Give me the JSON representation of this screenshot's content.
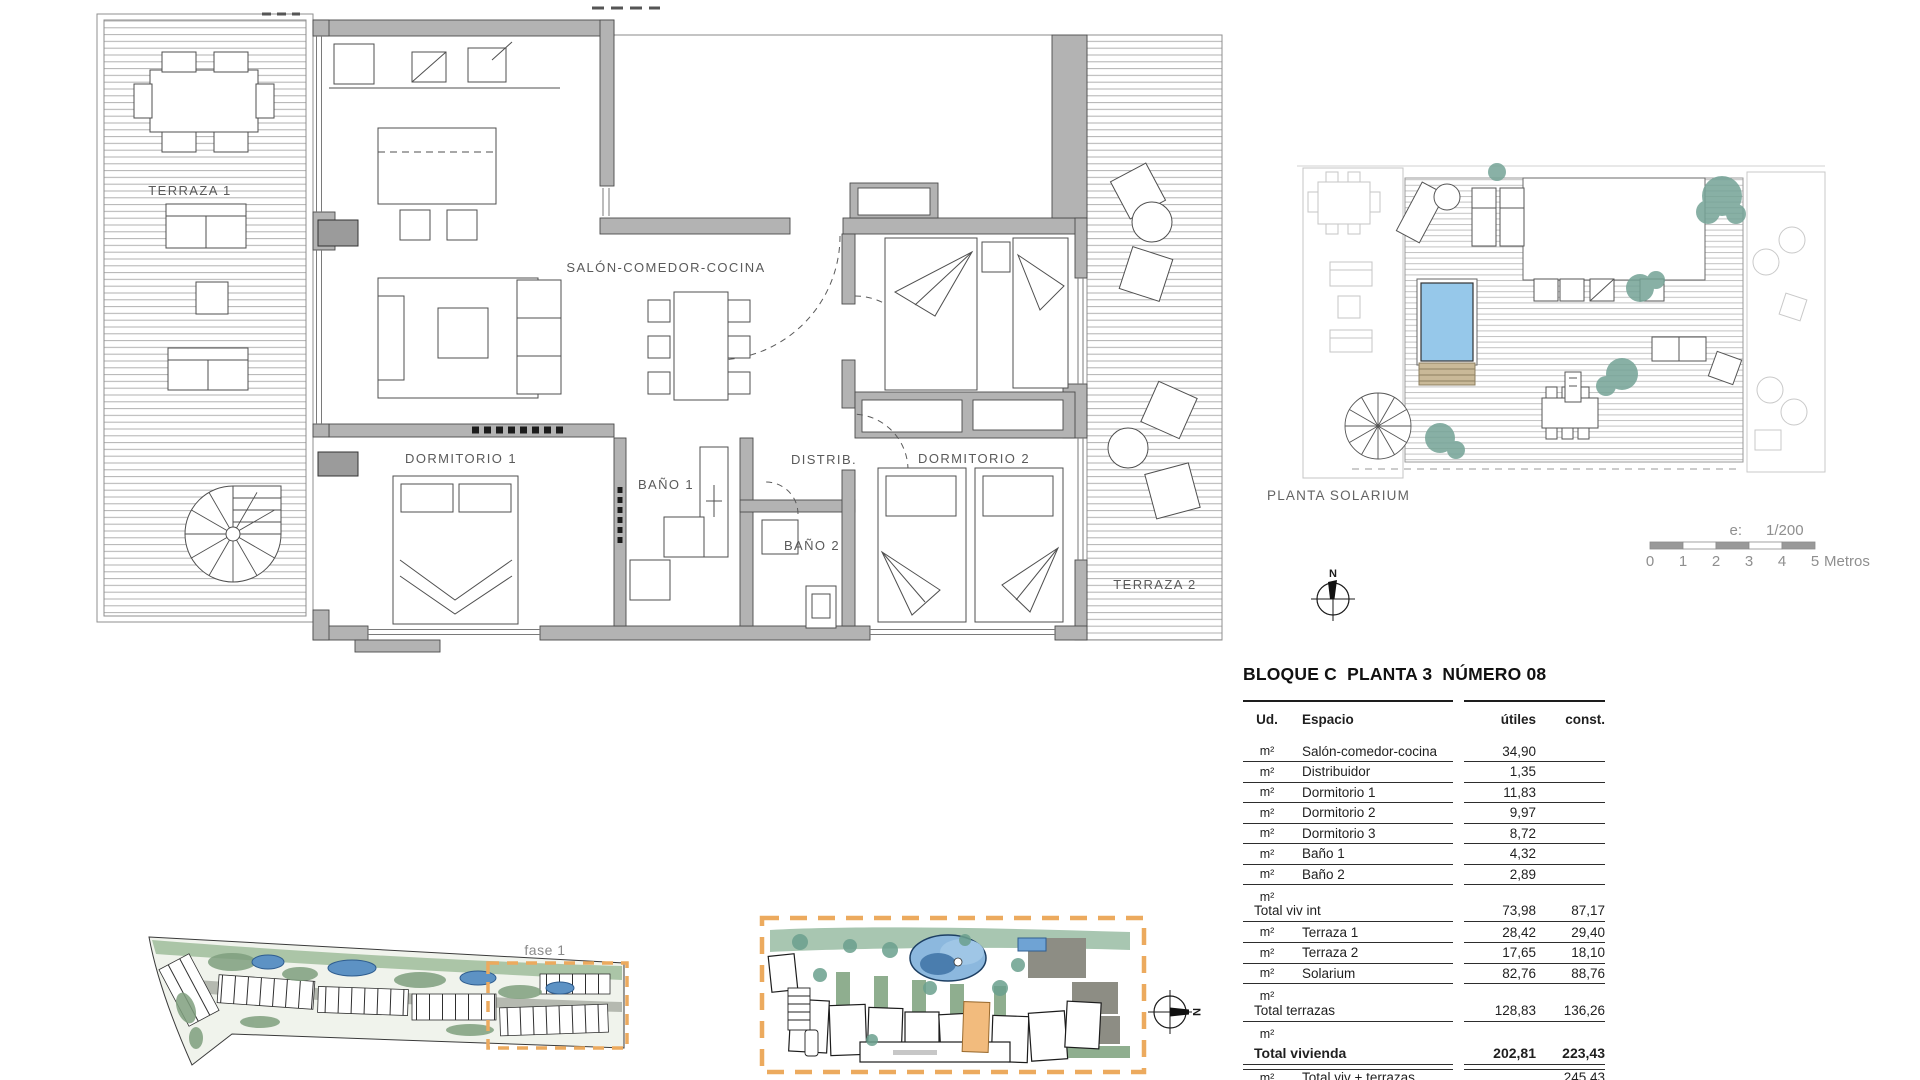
{
  "plan": {
    "labels": {
      "terraza1": "TERRAZA 1",
      "salon": "SALÓN-COMEDOR-COCINA",
      "dormitorio1": "DORMITORIO 1",
      "bano1": "BAÑO 1",
      "distrib": "DISTRIB.",
      "bano2": "BAÑO 2",
      "dormitorio2": "DORMITORIO 2",
      "terraza2": "TERRAZA 2"
    }
  },
  "solarium": {
    "caption": "PLANTA SOLARIUM"
  },
  "scale_bar": {
    "prefix": "e:",
    "ratio": "1/200",
    "ticks": [
      "0",
      "1",
      "2",
      "3",
      "4",
      "5"
    ],
    "unit": "Metros"
  },
  "compass": {
    "north": "N"
  },
  "site": {
    "phase_label": "fase 1"
  },
  "area_table": {
    "title": "BLOQUE C  PLANTA 3  NÚMERO 08",
    "col_ud": "Ud.",
    "col_espacio": "Espacio",
    "col_utiles": "útiles",
    "col_const": "const.",
    "m2": "m²",
    "rooms": [
      {
        "label": "Salón-comedor-cocina",
        "utiles": "34,90",
        "const": ""
      },
      {
        "label": "Distribuidor",
        "utiles": "1,35",
        "const": ""
      },
      {
        "label": "Dormitorio 1",
        "utiles": "11,83",
        "const": ""
      },
      {
        "label": "Dormitorio 2",
        "utiles": "9,97",
        "const": ""
      },
      {
        "label": "Dormitorio 3",
        "utiles": "8,72",
        "const": ""
      },
      {
        "label": "Baño 1",
        "utiles": "4,32",
        "const": ""
      },
      {
        "label": "Baño 2",
        "utiles": "2,89",
        "const": ""
      }
    ],
    "totals": [
      {
        "label": "Total viv int",
        "utiles": "73,98",
        "const": "87,17"
      },
      {
        "label": "Terraza 1",
        "utiles": "28,42",
        "const": "29,40"
      },
      {
        "label": "Terraza 2",
        "utiles": "17,65",
        "const": "18,10"
      },
      {
        "label": "Solarium",
        "utiles": "82,76",
        "const": "88,76"
      },
      {
        "label": "Total terrazas",
        "utiles": "128,83",
        "const": "136,26"
      },
      {
        "label": "Total vivienda",
        "utiles": "202,81",
        "const": "223,43"
      }
    ],
    "clipped_row": {
      "label": "Total viv + terrazas ZZCC",
      "utiles": "",
      "const": "245,43"
    }
  },
  "colors": {
    "wall_gray": "#b3b3b3",
    "line_dark": "#4a4a4a",
    "pool_blue": "#96c8ea",
    "plant_green": "#74a396",
    "site_green": "#9ec0a8",
    "site_pool_blue": "#4a7dae",
    "accent_orange": "#ecaa5e",
    "highlight_unit_orange": "#f2bb7d",
    "scale_gray": "#909090"
  }
}
